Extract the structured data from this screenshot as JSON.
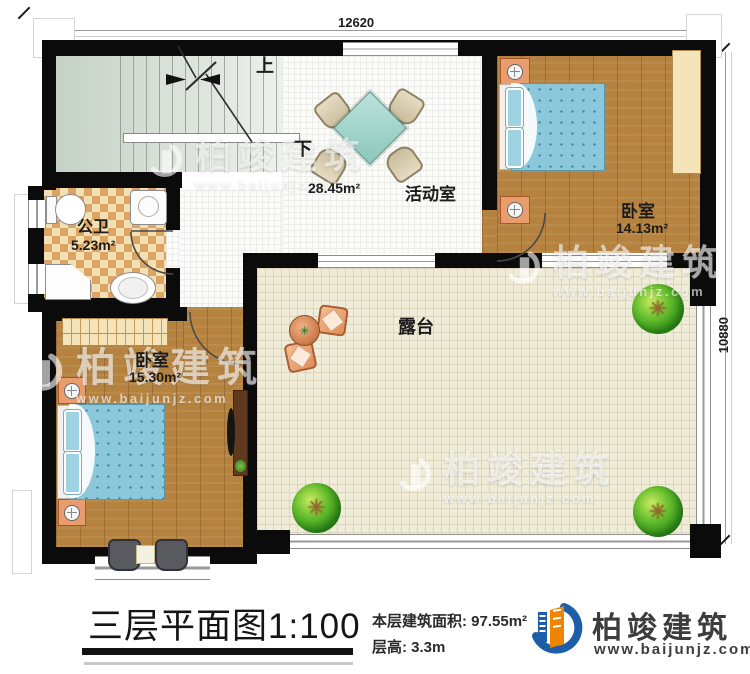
{
  "plan": {
    "dimension_top": "12620",
    "dimension_right": "10880",
    "stair_up": "上",
    "stair_down": "下",
    "rooms": {
      "activity": {
        "name": "活动室",
        "area": "28.45m²"
      },
      "bedroom1": {
        "name": "卧室",
        "area": "14.13m²"
      },
      "bathroom": {
        "name": "公卫",
        "area": "5.23m²"
      },
      "bedroom2": {
        "name": "卧室",
        "area": "15.30m²"
      },
      "terrace": {
        "name": "露台"
      }
    }
  },
  "footer": {
    "title": "三层平面图1:100",
    "floor_area_label": "本层建筑面积:",
    "floor_area_value": "97.55m²",
    "floor_height_label": "层高:",
    "floor_height_value": "3.3m"
  },
  "brand": {
    "name": "柏竣建筑",
    "website": "www.baijunjz.com"
  },
  "watermark": {
    "name": "柏竣建筑",
    "website": "www.baijunjz.com"
  },
  "colors": {
    "wall": "#0b0b0b",
    "wood_floor": "#b5833f",
    "terrace_floor": "#efecd9",
    "stair_floor": "#d3dcd3",
    "bath_tile": "#dba462",
    "bed_blue": "#8cc8dc",
    "brand_blue": "#1c5fa8",
    "brand_orange": "#f08300"
  }
}
